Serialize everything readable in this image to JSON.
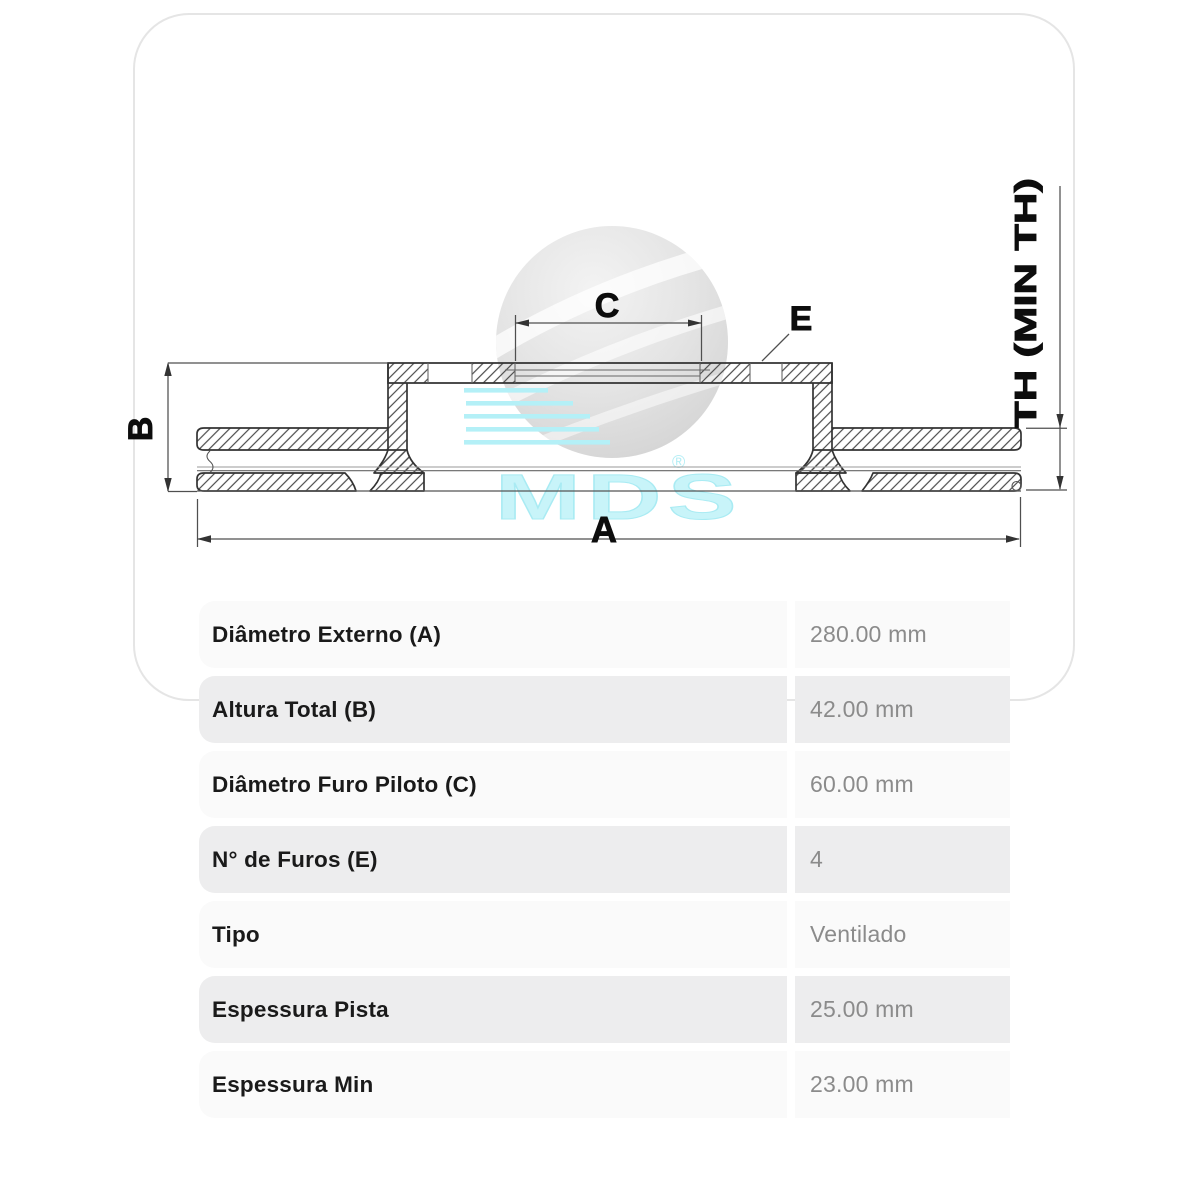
{
  "diagram": {
    "dimension_labels": {
      "outer_diameter": "A",
      "total_height": "B",
      "pilot_hole": "C",
      "holes": "E",
      "thickness": "TH (MIN TH)"
    },
    "watermark": {
      "brand": "MDS",
      "registered_mark": "®"
    }
  },
  "spec_table": {
    "rows": [
      {
        "label": "Diâmetro Externo (A)",
        "value": "280.00 mm"
      },
      {
        "label": "Altura Total (B)",
        "value": "42.00 mm"
      },
      {
        "label": "Diâmetro Furo Piloto (C)",
        "value": "60.00 mm"
      },
      {
        "label": "N° de Furos (E)",
        "value": "4"
      },
      {
        "label": "Tipo",
        "value": "Ventilado"
      },
      {
        "label": "Espessura Pista",
        "value": "25.00 mm"
      },
      {
        "label": "Espessura Min",
        "value": "23.00 mm"
      }
    ]
  },
  "colors": {
    "accent_cyan": "#b4f0f7",
    "watermark_text": "#c8f4f9",
    "row_light": "#fafafa",
    "row_gray": "#ededee",
    "card_border": "#e5e5e5",
    "label_text": "#1a1a1a",
    "value_text": "#8b8b8b",
    "line_dark": "#333333"
  }
}
